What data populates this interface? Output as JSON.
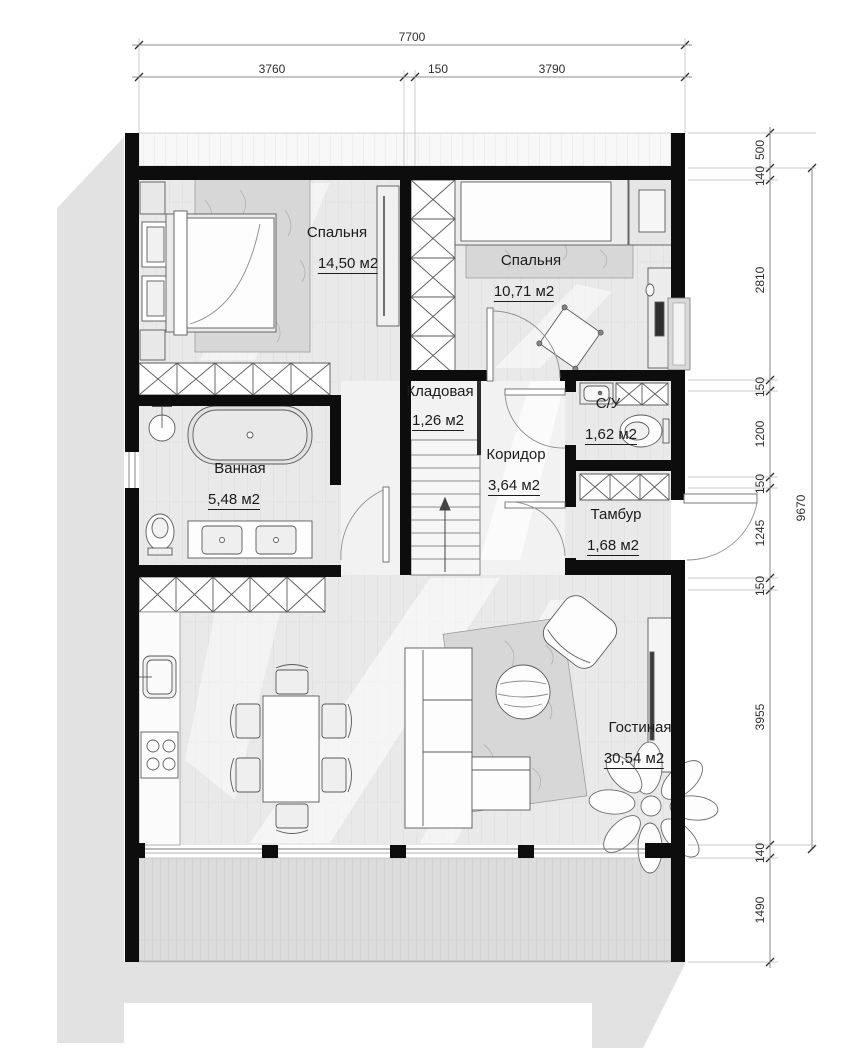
{
  "rooms": [
    {
      "name": "Спальня",
      "area": "14,50 м2"
    },
    {
      "name": "Спальня",
      "area": "10,71 м2"
    },
    {
      "name": "Кладовая",
      "area": "1,26 м2"
    },
    {
      "name": "С/У",
      "area": "1,62 м2"
    },
    {
      "name": "Коридор",
      "area": "3,64 м2"
    },
    {
      "name": "Тамбур",
      "area": "1,68 м2"
    },
    {
      "name": "Ванная",
      "area": "5,48 м2"
    },
    {
      "name": "Гостиная",
      "area": "30,54 м2"
    }
  ],
  "dims": {
    "top_total": "7700",
    "top": [
      "3760",
      "150",
      "3790"
    ],
    "right": [
      "500",
      "140",
      "2810",
      "150",
      "1200",
      "150",
      "1245",
      "150",
      "3955",
      "140",
      "1490"
    ],
    "right_total": "9670"
  },
  "colors": {
    "wall": "#0d0d0d",
    "floor": "#e9e9e9",
    "terrace": "#dcdcdc",
    "shadow": "#e2e2e2",
    "line": "#555555"
  }
}
